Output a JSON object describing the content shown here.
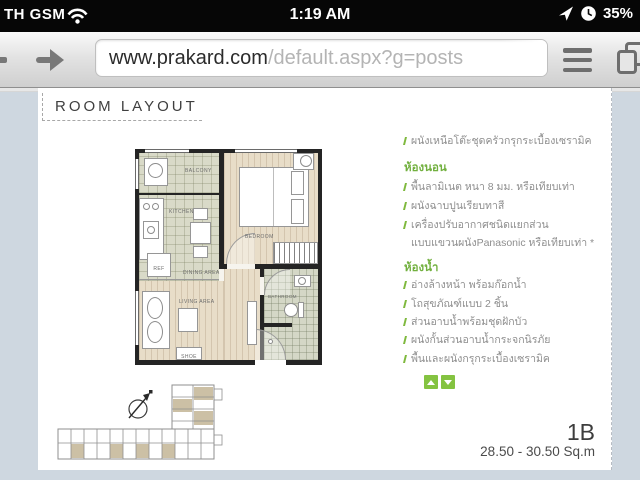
{
  "status_bar": {
    "carrier": "TH GSM",
    "time": "1:19 AM",
    "battery_percent": "35%"
  },
  "browser": {
    "url_domain": "www.prakard.com",
    "url_path": "/default.aspx?g=posts"
  },
  "content": {
    "section_title": "ROOM LAYOUT",
    "unit_name": "1B",
    "unit_area": "28.50 - 30.50 Sq.m",
    "specs": {
      "intro_item": "ผนังเหนือโต๊ะชุดครัวกรุกระเบื้องเซรามิค",
      "bedroom_heading": "ห้องนอน",
      "bedroom_items": [
        "พื้นลามิเนต หนา 8 มม. หรือเทียบเท่า",
        "ผนังฉาบปูนเรียบทาสี",
        "เครื่องปรับอากาศชนิดแยกส่วน",
        "แบบแขวนผนังPanasonic หรือเทียบเท่า *"
      ],
      "bathroom_heading": "ห้องน้ำ",
      "bathroom_items": [
        "อ่างล้างหน้า พร้อมก๊อกน้ำ",
        "โถสุขภัณฑ์แบบ 2 ชิ้น",
        "ส่วนอาบน้ำพร้อมชุดฝักบัว",
        "ผนังกั้นส่วนอาบน้ำกระจกนิรภัย",
        "พื้นและผนังกรุกระเบื้องเซรามิค"
      ]
    },
    "floorplan_labels": {
      "balcony": "BALCONY",
      "kitchen": "KITCHEN",
      "dining": "DINING AREA",
      "living": "LIVING AREA",
      "shoe": "SHOE",
      "bedroom": "BEDROOM",
      "bathroom": "BATHROOM",
      "ref": "REF"
    }
  },
  "colors": {
    "accent_green": "#7fb93e",
    "status_bar_bg": "#060606",
    "page_background": "#ced7e0",
    "floor_tile": "#d9dac8",
    "floor_wood": "#e8ddc8",
    "wall": "#242424"
  }
}
